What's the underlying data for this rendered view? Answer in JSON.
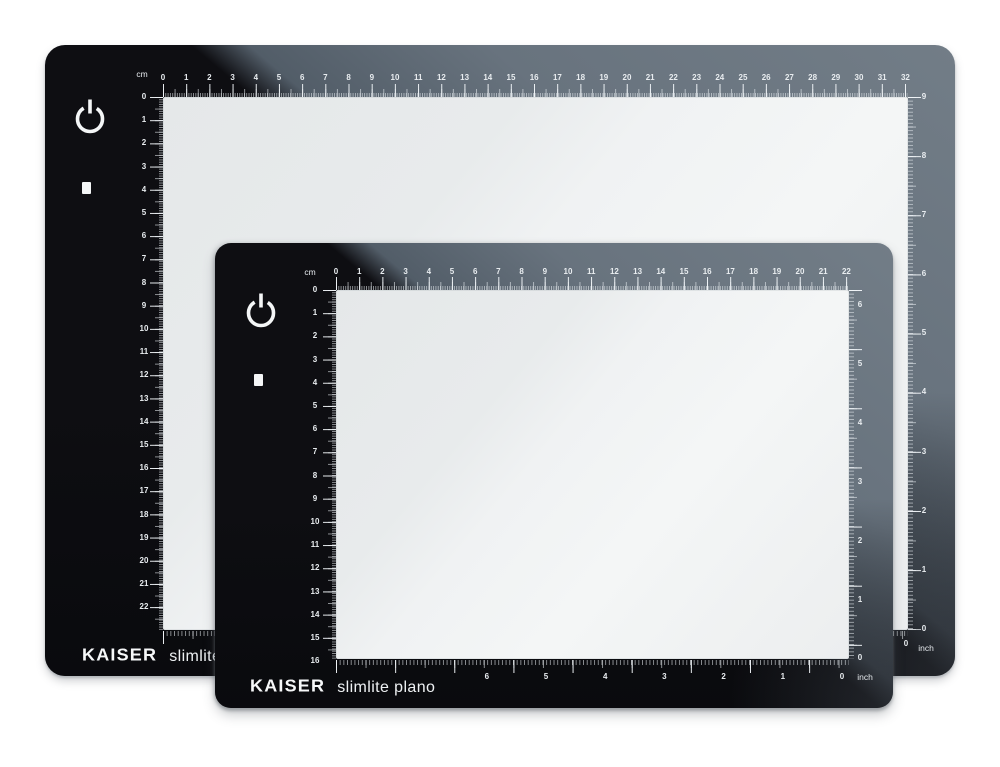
{
  "product": {
    "brand": "KAISER",
    "model": "slimlite plano",
    "description": "two LED light boxes, large behind and small in front"
  },
  "colors": {
    "background": "#ffffff",
    "frame_black": "#0e0e12",
    "reflection_gray": "#68737e",
    "light_surface": "#eceeef",
    "tick_white": "#f3f7fa"
  },
  "panels": [
    {
      "name": "large-lightbox",
      "brand": "KAISER",
      "model": "slimlite plano",
      "units": {
        "top": "cm",
        "side": "inch"
      },
      "icons": [
        "power-icon",
        "indicator-square"
      ],
      "rulers": {
        "top_cm": [
          "0",
          "1",
          "2",
          "3",
          "4",
          "5",
          "6",
          "7",
          "8",
          "9",
          "10",
          "11",
          "12",
          "13",
          "14",
          "15",
          "16",
          "17",
          "18",
          "19",
          "20",
          "21",
          "22",
          "23",
          "24",
          "25",
          "26",
          "27",
          "28",
          "29",
          "30",
          "31",
          "32"
        ],
        "left_cm": [
          "0",
          "1",
          "2",
          "3",
          "4",
          "5",
          "6",
          "7",
          "8",
          "9",
          "10",
          "11",
          "12",
          "13",
          "14",
          "15",
          "16",
          "17",
          "18",
          "19",
          "20",
          "21",
          "22"
        ],
        "right_inch": [
          "9",
          "8",
          "7",
          "6",
          "5",
          "4",
          "3",
          "2",
          "1",
          "0"
        ],
        "bottom_inch": [
          "0",
          "1",
          "2",
          "3",
          "4",
          "5",
          "6",
          "7",
          "8"
        ]
      }
    },
    {
      "name": "small-lightbox",
      "brand": "KAISER",
      "model": "slimlite plano",
      "units": {
        "top": "cm",
        "side": "inch"
      },
      "icons": [
        "power-icon",
        "indicator-square"
      ],
      "rulers": {
        "top_cm": [
          "0",
          "1",
          "2",
          "3",
          "4",
          "5",
          "6",
          "7",
          "8",
          "9",
          "10",
          "11",
          "12",
          "13",
          "14",
          "15",
          "16",
          "17",
          "18",
          "19",
          "20",
          "21",
          "22"
        ],
        "left_cm": [
          "0",
          "1",
          "2",
          "3",
          "4",
          "5",
          "6",
          "7",
          "8",
          "9",
          "10",
          "11",
          "12",
          "13",
          "14",
          "15",
          "16"
        ],
        "right_inch": [
          "6",
          "5",
          "4",
          "3",
          "2",
          "1",
          "0"
        ],
        "bottom_inch": [
          "0",
          "1",
          "2",
          "3",
          "4",
          "5",
          "6"
        ]
      }
    }
  ]
}
